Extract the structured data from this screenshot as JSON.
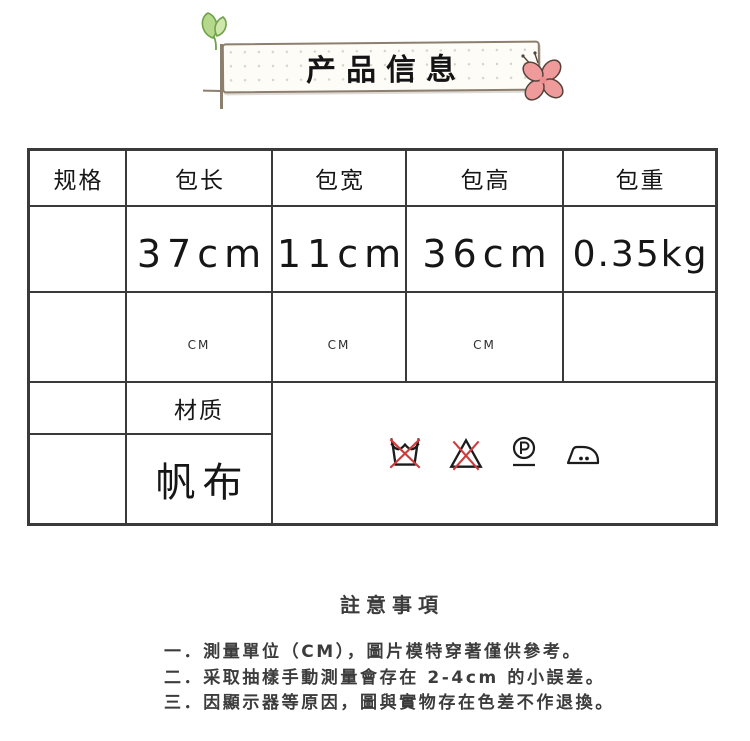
{
  "banner": {
    "title": "产品信息",
    "decorations": [
      "sprout-icon",
      "flower-icon"
    ]
  },
  "table": {
    "headers": [
      "规格",
      "包长",
      "包宽",
      "包高",
      "包重"
    ],
    "size_row": [
      "",
      "37cm",
      "11cm",
      "36cm",
      "0.35kg"
    ],
    "unit_row": [
      "",
      "CM",
      "CM",
      "CM",
      ""
    ],
    "material_label": "材质",
    "material_value": "帆布",
    "care_symbols": [
      "do-not-wash",
      "do-not-bleach",
      "dry-clean-P",
      "iron-two-dots"
    ]
  },
  "notes": {
    "heading": "註意事項",
    "items": [
      "一．測量單位（CM），圖片模特穿著僅供參考。",
      "二．采取抽樣手動測量會存在 2-4cm 的小誤差。",
      "三．因顯示器等原因，圖與實物存在色差不作退換。"
    ]
  },
  "colors": {
    "table_border": "#3a3a3a",
    "banner_outline": "#8d7f6e",
    "leaf_green": "#b5d98c",
    "flower_pink": "#f09b9b",
    "care_red": "#cf3b3b",
    "text": "#161616",
    "note_text": "#3c3c3c"
  }
}
